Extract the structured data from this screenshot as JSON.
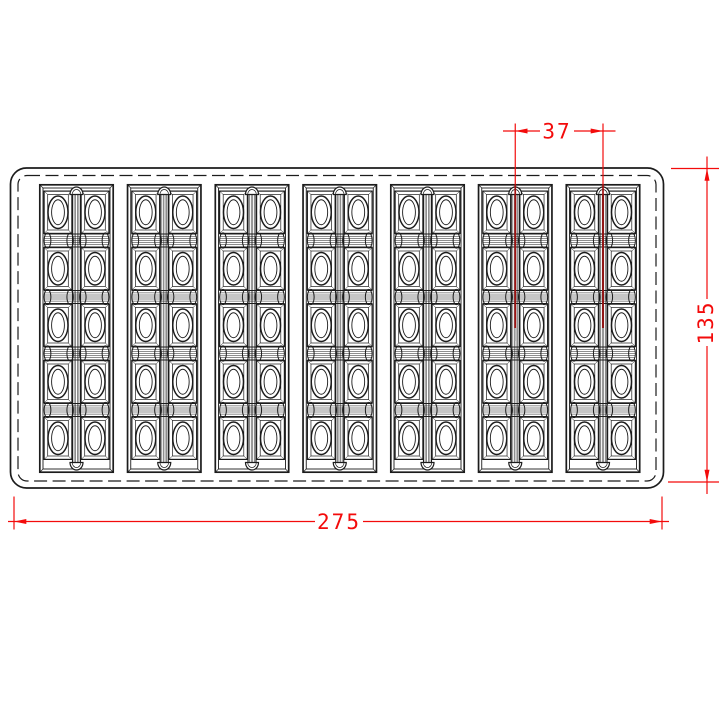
{
  "drawing": {
    "bars_count": 7,
    "rows_per_bar": 5,
    "cavities_per_row": 2
  },
  "dimensions": {
    "pitch": {
      "label": "37"
    },
    "width": {
      "label": "275"
    },
    "height": {
      "label": "135"
    }
  },
  "colors": {
    "linework": "#1c1c1c",
    "dimension_red": "#f30b0b",
    "centerline_dark_red": "#a31212",
    "centerline_tail_gray": "#bbbbbb",
    "background": "#ffffff"
  }
}
